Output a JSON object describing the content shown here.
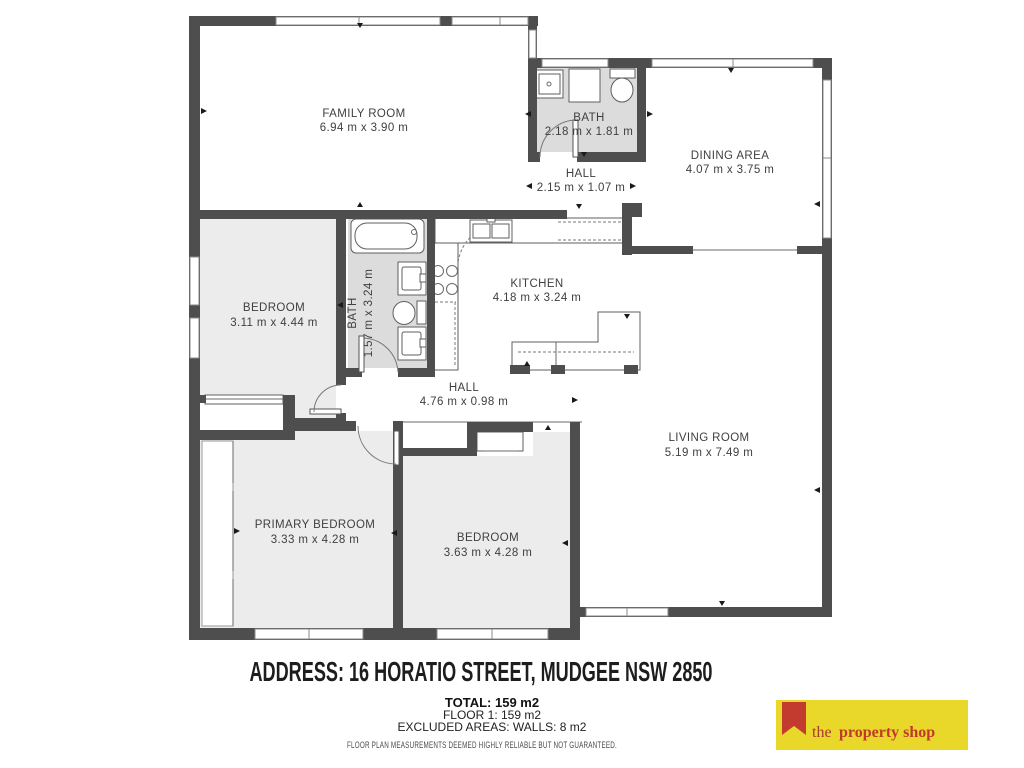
{
  "floorplan": {
    "rooms": [
      {
        "name": "FAMILY ROOM",
        "dims": "6.94 m x 3.90 m"
      },
      {
        "name": "BATH",
        "dims": "2.18 m x 1.81 m"
      },
      {
        "name": "HALL",
        "dims": "2.15 m x 1.07 m"
      },
      {
        "name": "DINING AREA",
        "dims": "4.07 m x 3.75 m"
      },
      {
        "name": "BEDROOM",
        "dims": "3.11 m x 4.44 m"
      },
      {
        "name": "BATH",
        "dims": "1.57 m x 3.24 m"
      },
      {
        "name": "KITCHEN",
        "dims": "4.18 m x 3.24 m"
      },
      {
        "name": "HALL",
        "dims": "4.76 m x 0.98 m"
      },
      {
        "name": "LIVING ROOM",
        "dims": "5.19 m x 7.49 m"
      },
      {
        "name": "PRIMARY BEDROOM",
        "dims": "3.33 m x 4.28 m"
      },
      {
        "name": "BEDROOM",
        "dims": "3.63 m x 4.28 m"
      }
    ],
    "colors": {
      "wall": "#4e4e4e",
      "room_fill": "#ececec",
      "bath_fill": "#dcdcdc"
    }
  },
  "footer": {
    "address": "ADDRESS: 16 HORATIO STREET, MUDGEE NSW 2850",
    "total": "TOTAL: 159 m2",
    "floor": "FLOOR 1: 159 m2",
    "excluded": "EXCLUDED AREAS: WALLS: 8 m2",
    "disclaimer": "FLOOR PLAN MEASUREMENTS DEEMED HIGHLY RELIABLE BUT NOT GUARANTEED."
  },
  "logo": {
    "word_the": "the",
    "word_rest": "property shop",
    "bg_color": "#e9d829",
    "accent_color": "#bf3a2b"
  }
}
